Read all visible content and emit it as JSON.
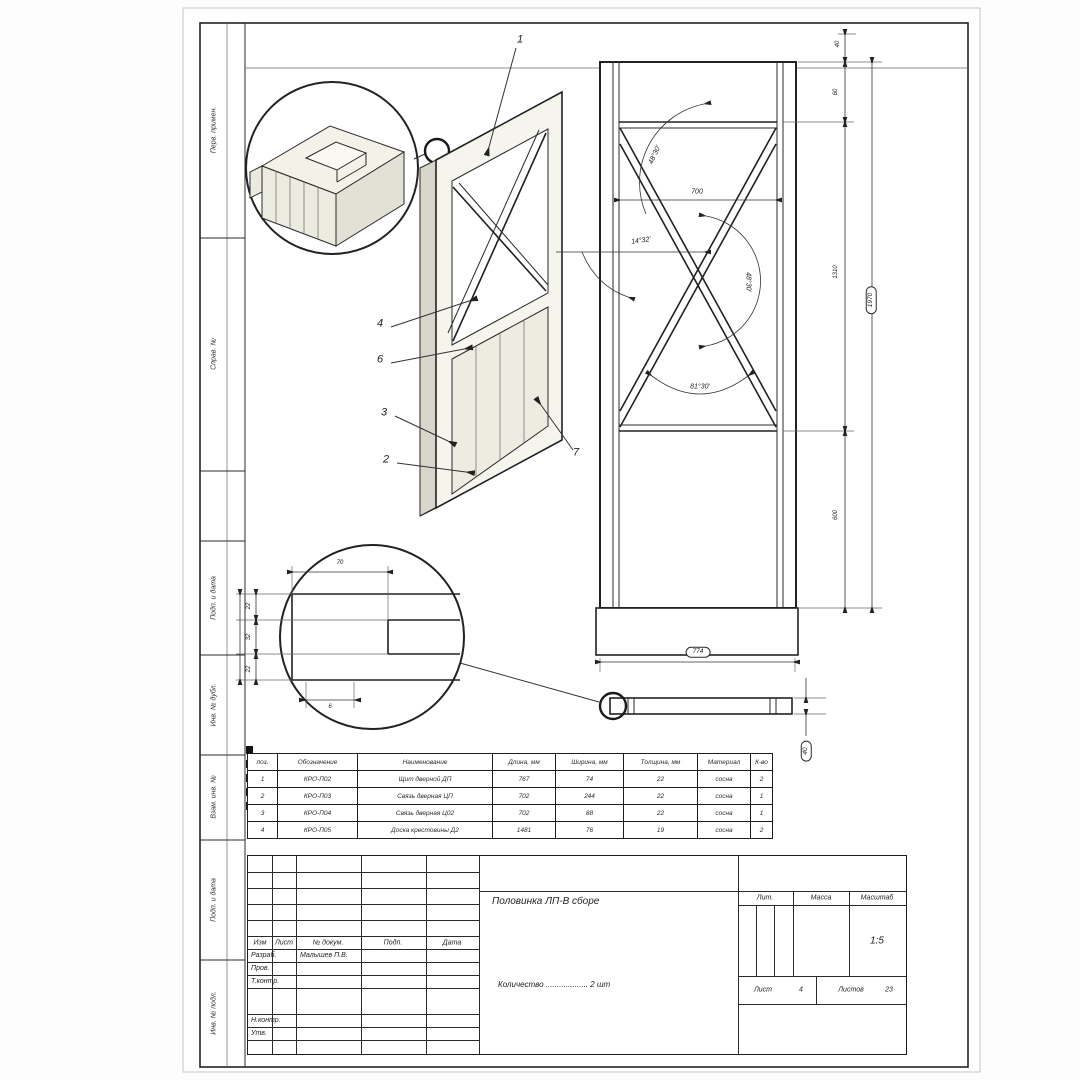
{
  "sheet": {
    "margin_labels": [
      "Перв. примен.",
      "Справ. №",
      "Подп. и дата",
      "Инв. № дубл.",
      "Взам. инв. №",
      "Подп. и дата",
      "Инв. № подл."
    ],
    "line_color": "#2a2a2a",
    "wood_face_color": "#f5f4ed"
  },
  "parts_table": {
    "headers": [
      "поз.",
      "Обозначение",
      "Наименование",
      "Длина, мм",
      "Ширина, мм",
      "Толщина, мм",
      "Материал",
      "К-во"
    ],
    "rows": [
      [
        "1",
        "КРО-П02",
        "Щит дверной ДП",
        "767",
        "74",
        "22",
        "сосна",
        "2"
      ],
      [
        "2",
        "КРО-П03",
        "Связь дверная ЦП",
        "702",
        "244",
        "22",
        "сосна",
        "1"
      ],
      [
        "3",
        "КРО-П04",
        "Связь дверная Ц02",
        "702",
        "88",
        "22",
        "сосна",
        "1"
      ],
      [
        "4",
        "КРО-П05",
        "Доска крестовины Д2",
        "1481",
        "76",
        "19",
        "сосна",
        "2"
      ]
    ]
  },
  "title_block": {
    "header_cols": [
      "Изм",
      "Лист",
      "№ докум.",
      "Подп.",
      "Дата"
    ],
    "row_labels": {
      "developed": "Разраб.",
      "checked": "Пров.",
      "tcontrol": "Т.контр.",
      "ncontrol": "Н.контр.",
      "approved": "Утв."
    },
    "developer_name": "Малышев П.В.",
    "doc_title": "Половинка ЛП-В сборе",
    "quantity_line": "Количество ................... 2 шт",
    "lit_label": "Лит.",
    "mass_label": "Масса",
    "scale_label": "Масштаб",
    "scale_value": "1:5",
    "sheet_label": "Лист",
    "sheet_value": "4",
    "sheets_label": "Листов",
    "sheets_value": "23"
  },
  "annotations": [
    {
      "name": "callout-1",
      "text": "1",
      "x": 520,
      "y": 40,
      "fs": 11
    },
    {
      "name": "callout-4",
      "text": "4",
      "x": 380,
      "y": 324,
      "fs": 11
    },
    {
      "name": "callout-6",
      "text": "6",
      "x": 380,
      "y": 360,
      "fs": 11
    },
    {
      "name": "callout-3",
      "text": "3",
      "x": 384,
      "y": 413,
      "fs": 11
    },
    {
      "name": "callout-2",
      "text": "2",
      "x": 386,
      "y": 460,
      "fs": 11
    },
    {
      "name": "callout-7",
      "text": "7",
      "x": 576,
      "y": 453,
      "fs": 11
    },
    {
      "name": "dim-width-700",
      "text": "700",
      "x": 697,
      "y": 192,
      "fs": 7
    },
    {
      "name": "angle-top",
      "text": "48°30'",
      "x": 655,
      "y": 155,
      "fs": 7,
      "rot": -65
    },
    {
      "name": "angle-left",
      "text": "14°32'",
      "x": 641,
      "y": 241,
      "fs": 7,
      "rot": -8
    },
    {
      "name": "angle-right",
      "text": "48°30'",
      "x": 748,
      "y": 282,
      "fs": 7,
      "rot": 90
    },
    {
      "name": "angle-bottom",
      "text": "81°30'",
      "x": 700,
      "y": 387,
      "fs": 7
    },
    {
      "name": "dim-top-40",
      "text": "40",
      "x": 838,
      "y": 44,
      "fs": 6,
      "rot": -90
    },
    {
      "name": "dim-right-60",
      "text": "60",
      "x": 836,
      "y": 92,
      "fs": 6,
      "rot": -90
    },
    {
      "name": "dim-right-1310",
      "text": "1310",
      "x": 836,
      "y": 272,
      "fs": 6,
      "rot": -90
    },
    {
      "name": "dim-right-600",
      "text": "600",
      "x": 836,
      "y": 515,
      "fs": 6,
      "rot": -90
    },
    {
      "name": "dim-height-1970",
      "text": "1970",
      "x": 871,
      "y": 300,
      "fs": 6.5,
      "rot": -90,
      "balloon": true
    },
    {
      "name": "dim-bottom-774",
      "text": "774",
      "x": 698,
      "y": 652,
      "fs": 6.5,
      "balloon": true
    },
    {
      "name": "dim-plank-40",
      "text": "40",
      "x": 806,
      "y": 751,
      "fs": 6.5,
      "rot": -90,
      "balloon": true
    },
    {
      "name": "detail-b-dim-70",
      "text": "70",
      "x": 340,
      "y": 563,
      "fs": 6
    },
    {
      "name": "detail-b-dim-22a",
      "text": "22",
      "x": 249,
      "y": 606,
      "fs": 6,
      "rot": -90
    },
    {
      "name": "detail-b-dim-32",
      "text": "32",
      "x": 249,
      "y": 637,
      "fs": 6,
      "rot": -90
    },
    {
      "name": "detail-b-dim-22b",
      "text": "22",
      "x": 249,
      "y": 669,
      "fs": 6,
      "rot": -90
    },
    {
      "name": "detail-b-dim-6",
      "text": "6",
      "x": 330,
      "y": 707,
      "fs": 6
    }
  ]
}
